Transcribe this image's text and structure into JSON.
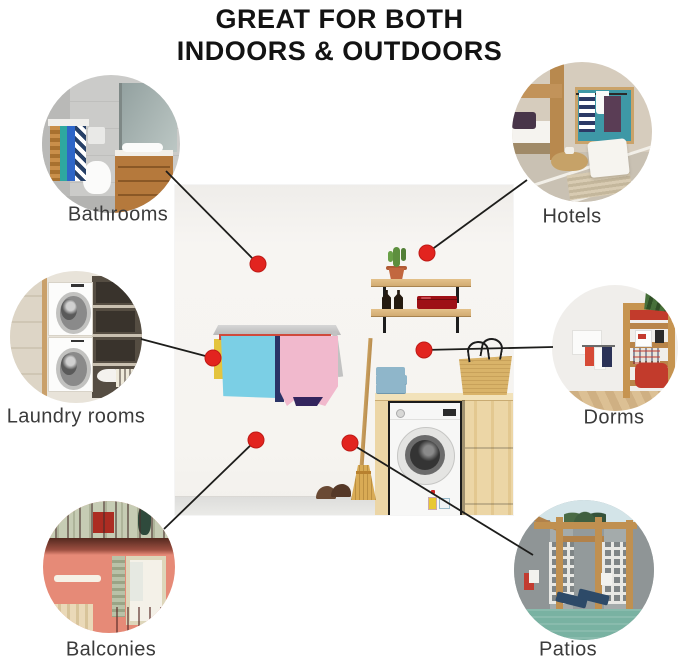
{
  "title": {
    "line1": "GREAT FOR BOTH",
    "line2": "INDOORS & OUTDOORS"
  },
  "style": {
    "accent_red": "#e2241f",
    "accent_red_edge": "#bf1a16",
    "connector_line": "#1d1d1b",
    "label_text": "#3b3b3b",
    "title_text": "#131313",
    "dot_radius": 8,
    "line_width": 1.8
  },
  "center_image": {
    "description": "Laundry room with wall-mounted drying rack holding blue and pink towels, wall shelf with cactus pot, two bottles and red case, wooden cabinet with front-load washing machine, folded blue towels, straw basket, broom and brown shoes"
  },
  "callouts": [
    {
      "id": "bathrooms",
      "label": "Bathrooms",
      "position": "top-left",
      "photo_alt": "Bathroom with grey tiles, wall-hung toilet, wooden vanity, mirror and towel rack",
      "circle": {
        "cx": 111,
        "cy": 144,
        "r": 69
      },
      "label_pos": {
        "x": 118,
        "y": 215
      },
      "dot": {
        "x": 258,
        "y": 264
      },
      "line": {
        "x1": 166,
        "y1": 171,
        "x2": 258,
        "y2": 264
      }
    },
    {
      "id": "hotels",
      "label": "Hotels",
      "position": "top-right",
      "photo_alt": "Hotel room with wooden bunk bed, teal towel niche, cushion and woven basket",
      "circle": {
        "cx": 582,
        "cy": 132,
        "r": 70
      },
      "label_pos": {
        "x": 572,
        "y": 217
      },
      "dot": {
        "x": 427,
        "y": 253
      },
      "line": {
        "x1": 527,
        "y1": 180,
        "x2": 427,
        "y2": 253
      }
    },
    {
      "id": "laundry-rooms",
      "label": "Laundry rooms",
      "position": "middle-left",
      "photo_alt": "Laundry closet with stacked washer and dryer and shelving",
      "circle": {
        "cx": 76,
        "cy": 337,
        "r": 66
      },
      "label_pos": {
        "x": 76,
        "y": 417
      },
      "dot": {
        "x": 213,
        "y": 358
      },
      "line": {
        "x1": 141,
        "y1": 339,
        "x2": 213,
        "y2": 358
      }
    },
    {
      "id": "dorms",
      "label": "Dorms",
      "position": "middle-right",
      "photo_alt": "Dorm room with wooden loft bed, ladder, red bedding and wall towel rack",
      "circle": {
        "cx": 615,
        "cy": 348,
        "r": 63
      },
      "label_pos": {
        "x": 614,
        "y": 418
      },
      "dot": {
        "x": 424,
        "y": 350
      },
      "line": {
        "x1": 424,
        "y1": 350,
        "x2": 553,
        "y2": 347
      }
    },
    {
      "id": "balconies",
      "label": "Balconies",
      "position": "bottom-left",
      "photo_alt": "Coral building facade with balconies, green shutters and railings",
      "circle": {
        "cx": 109,
        "cy": 567,
        "r": 66
      },
      "label_pos": {
        "x": 111,
        "y": 650
      },
      "dot": {
        "x": 256,
        "y": 440
      },
      "line": {
        "x1": 256,
        "y1": 440,
        "x2": 164,
        "y2": 529
      }
    },
    {
      "id": "patios",
      "label": "Patios",
      "position": "bottom-right",
      "photo_alt": "Poolside patio with wooden pergola, breeze-block screens, palm and blue loungers",
      "circle": {
        "cx": 584,
        "cy": 570,
        "r": 70
      },
      "label_pos": {
        "x": 568,
        "y": 650
      },
      "dot": {
        "x": 350,
        "y": 443
      },
      "line": {
        "x1": 350,
        "y1": 443,
        "x2": 533,
        "y2": 555
      }
    }
  ]
}
